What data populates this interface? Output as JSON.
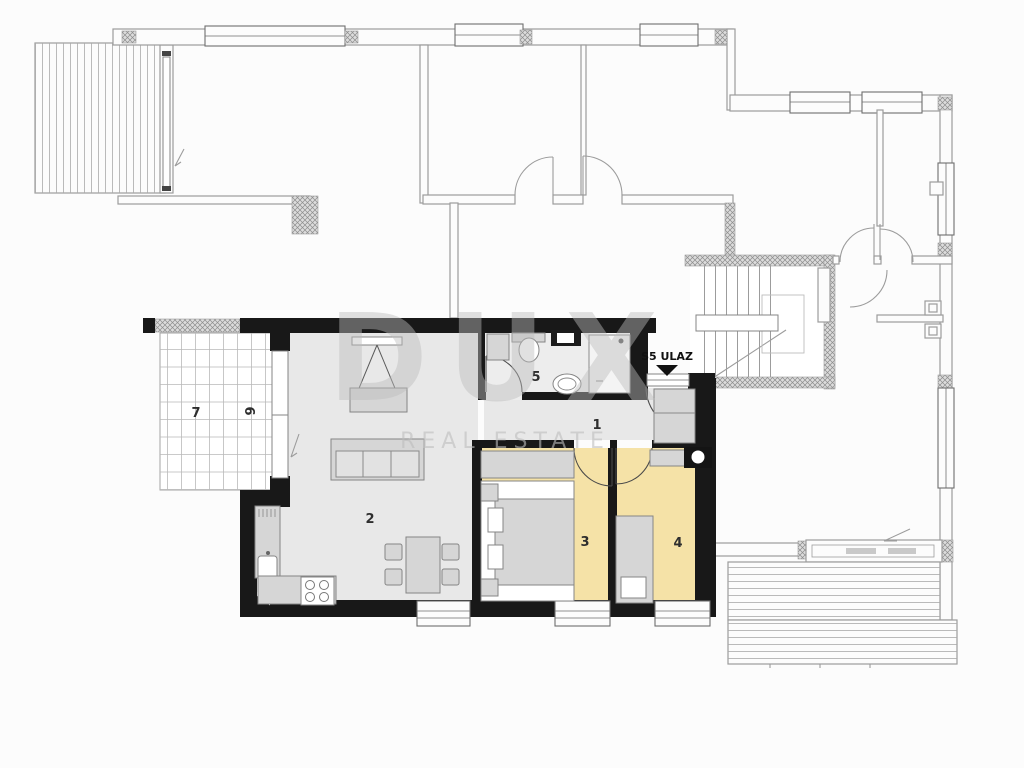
{
  "plan": {
    "entrance_label": "S5 ULAZ",
    "watermark": {
      "line1": "DUX",
      "line2": "REAL ESTATE"
    },
    "rooms": [
      {
        "label": "1",
        "name": "hallway"
      },
      {
        "label": "2",
        "name": "living-kitchen"
      },
      {
        "label": "3",
        "name": "bedroom-double"
      },
      {
        "label": "4",
        "name": "bedroom-single"
      },
      {
        "label": "5",
        "name": "bathroom"
      },
      {
        "label": "6",
        "name": "terrace-strip"
      },
      {
        "label": "7",
        "name": "terrace-main"
      }
    ],
    "colors": {
      "bg": "#fcfcfc",
      "wall": "#181818",
      "floor": "#e8e8e8",
      "bath_floor": "#ededed",
      "bedroom": "#f5e2a7",
      "furniture": "#d6d6d6",
      "furniture_white": "#ffffff",
      "furniture_stroke": "#858585",
      "neighbor": "#9c9c9c",
      "grid": "#b9b9b9",
      "watermark": "#bdbdbd",
      "label": "#2e2e2e"
    }
  }
}
